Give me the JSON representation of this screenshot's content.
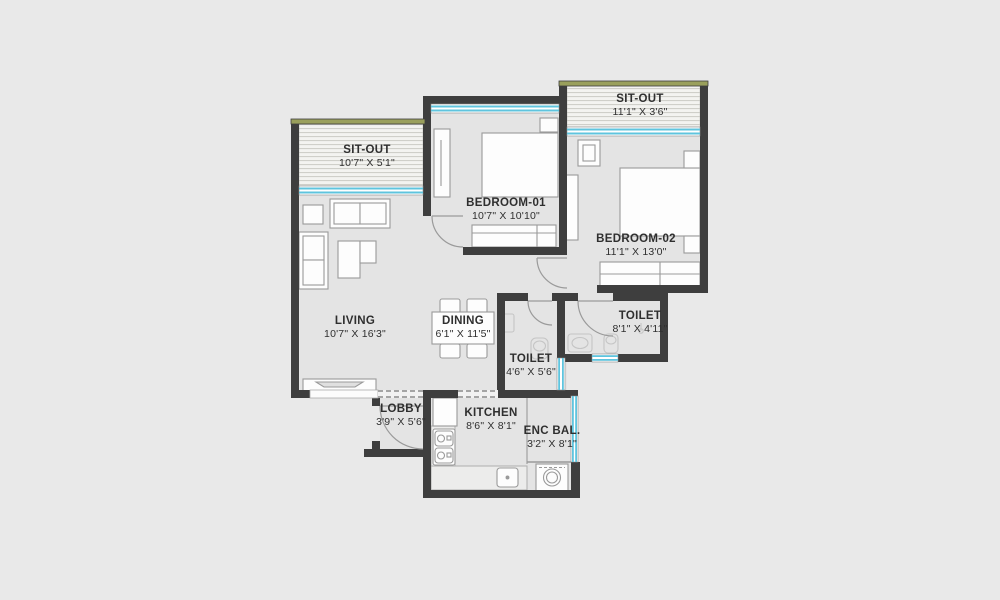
{
  "page": {
    "type": "apartment-floor-plan",
    "background": "#e9e9e9"
  },
  "colors": {
    "outside": "#e9e9e9",
    "floor": "#e4e4e4",
    "wall": "#3e3e3e",
    "window_cyan": "#5fc4de",
    "balcony_edge_olive": "#9aa05c",
    "hatch_line": "#cbcbc5",
    "hatch_bg": "#f3f3f0",
    "furniture_outline": "#9a9a9a",
    "furniture_fill": "#fdfdfd",
    "counter_fill": "#ececeb",
    "fixture_outline": "#c5c5c5",
    "door_arc": "#9a9a9a",
    "text": "#2f2f2f"
  },
  "rooms": [
    {
      "id": "sit-out-left",
      "name": "SIT-OUT",
      "dims": "10'7\" X 5'1\""
    },
    {
      "id": "sit-out-right",
      "name": "SIT-OUT",
      "dims": "11'1\" X 3'6\""
    },
    {
      "id": "bedroom-01",
      "name": "BEDROOM-01",
      "dims": "10'7\" X 10'10\""
    },
    {
      "id": "bedroom-02",
      "name": "BEDROOM-02",
      "dims": "11'1\" X 13'0\""
    },
    {
      "id": "living",
      "name": "LIVING",
      "dims": "10'7\" X 16'3\""
    },
    {
      "id": "dining",
      "name": "DINING",
      "dims": "6'1\" X 11'5\""
    },
    {
      "id": "toilet-right",
      "name": "TOILET",
      "dims": "8'1\" X 4'11\""
    },
    {
      "id": "toilet-mid",
      "name": "TOILET",
      "dims": "4'6\" X 5'6\""
    },
    {
      "id": "lobby",
      "name": "LOBBY",
      "dims": "3'9\" X 5'6\""
    },
    {
      "id": "kitchen",
      "name": "KITCHEN",
      "dims": "8'6\" X 8'1\""
    },
    {
      "id": "enc-bal",
      "name": "ENC BAL.",
      "dims": "3'2\" X 8'1\""
    }
  ]
}
